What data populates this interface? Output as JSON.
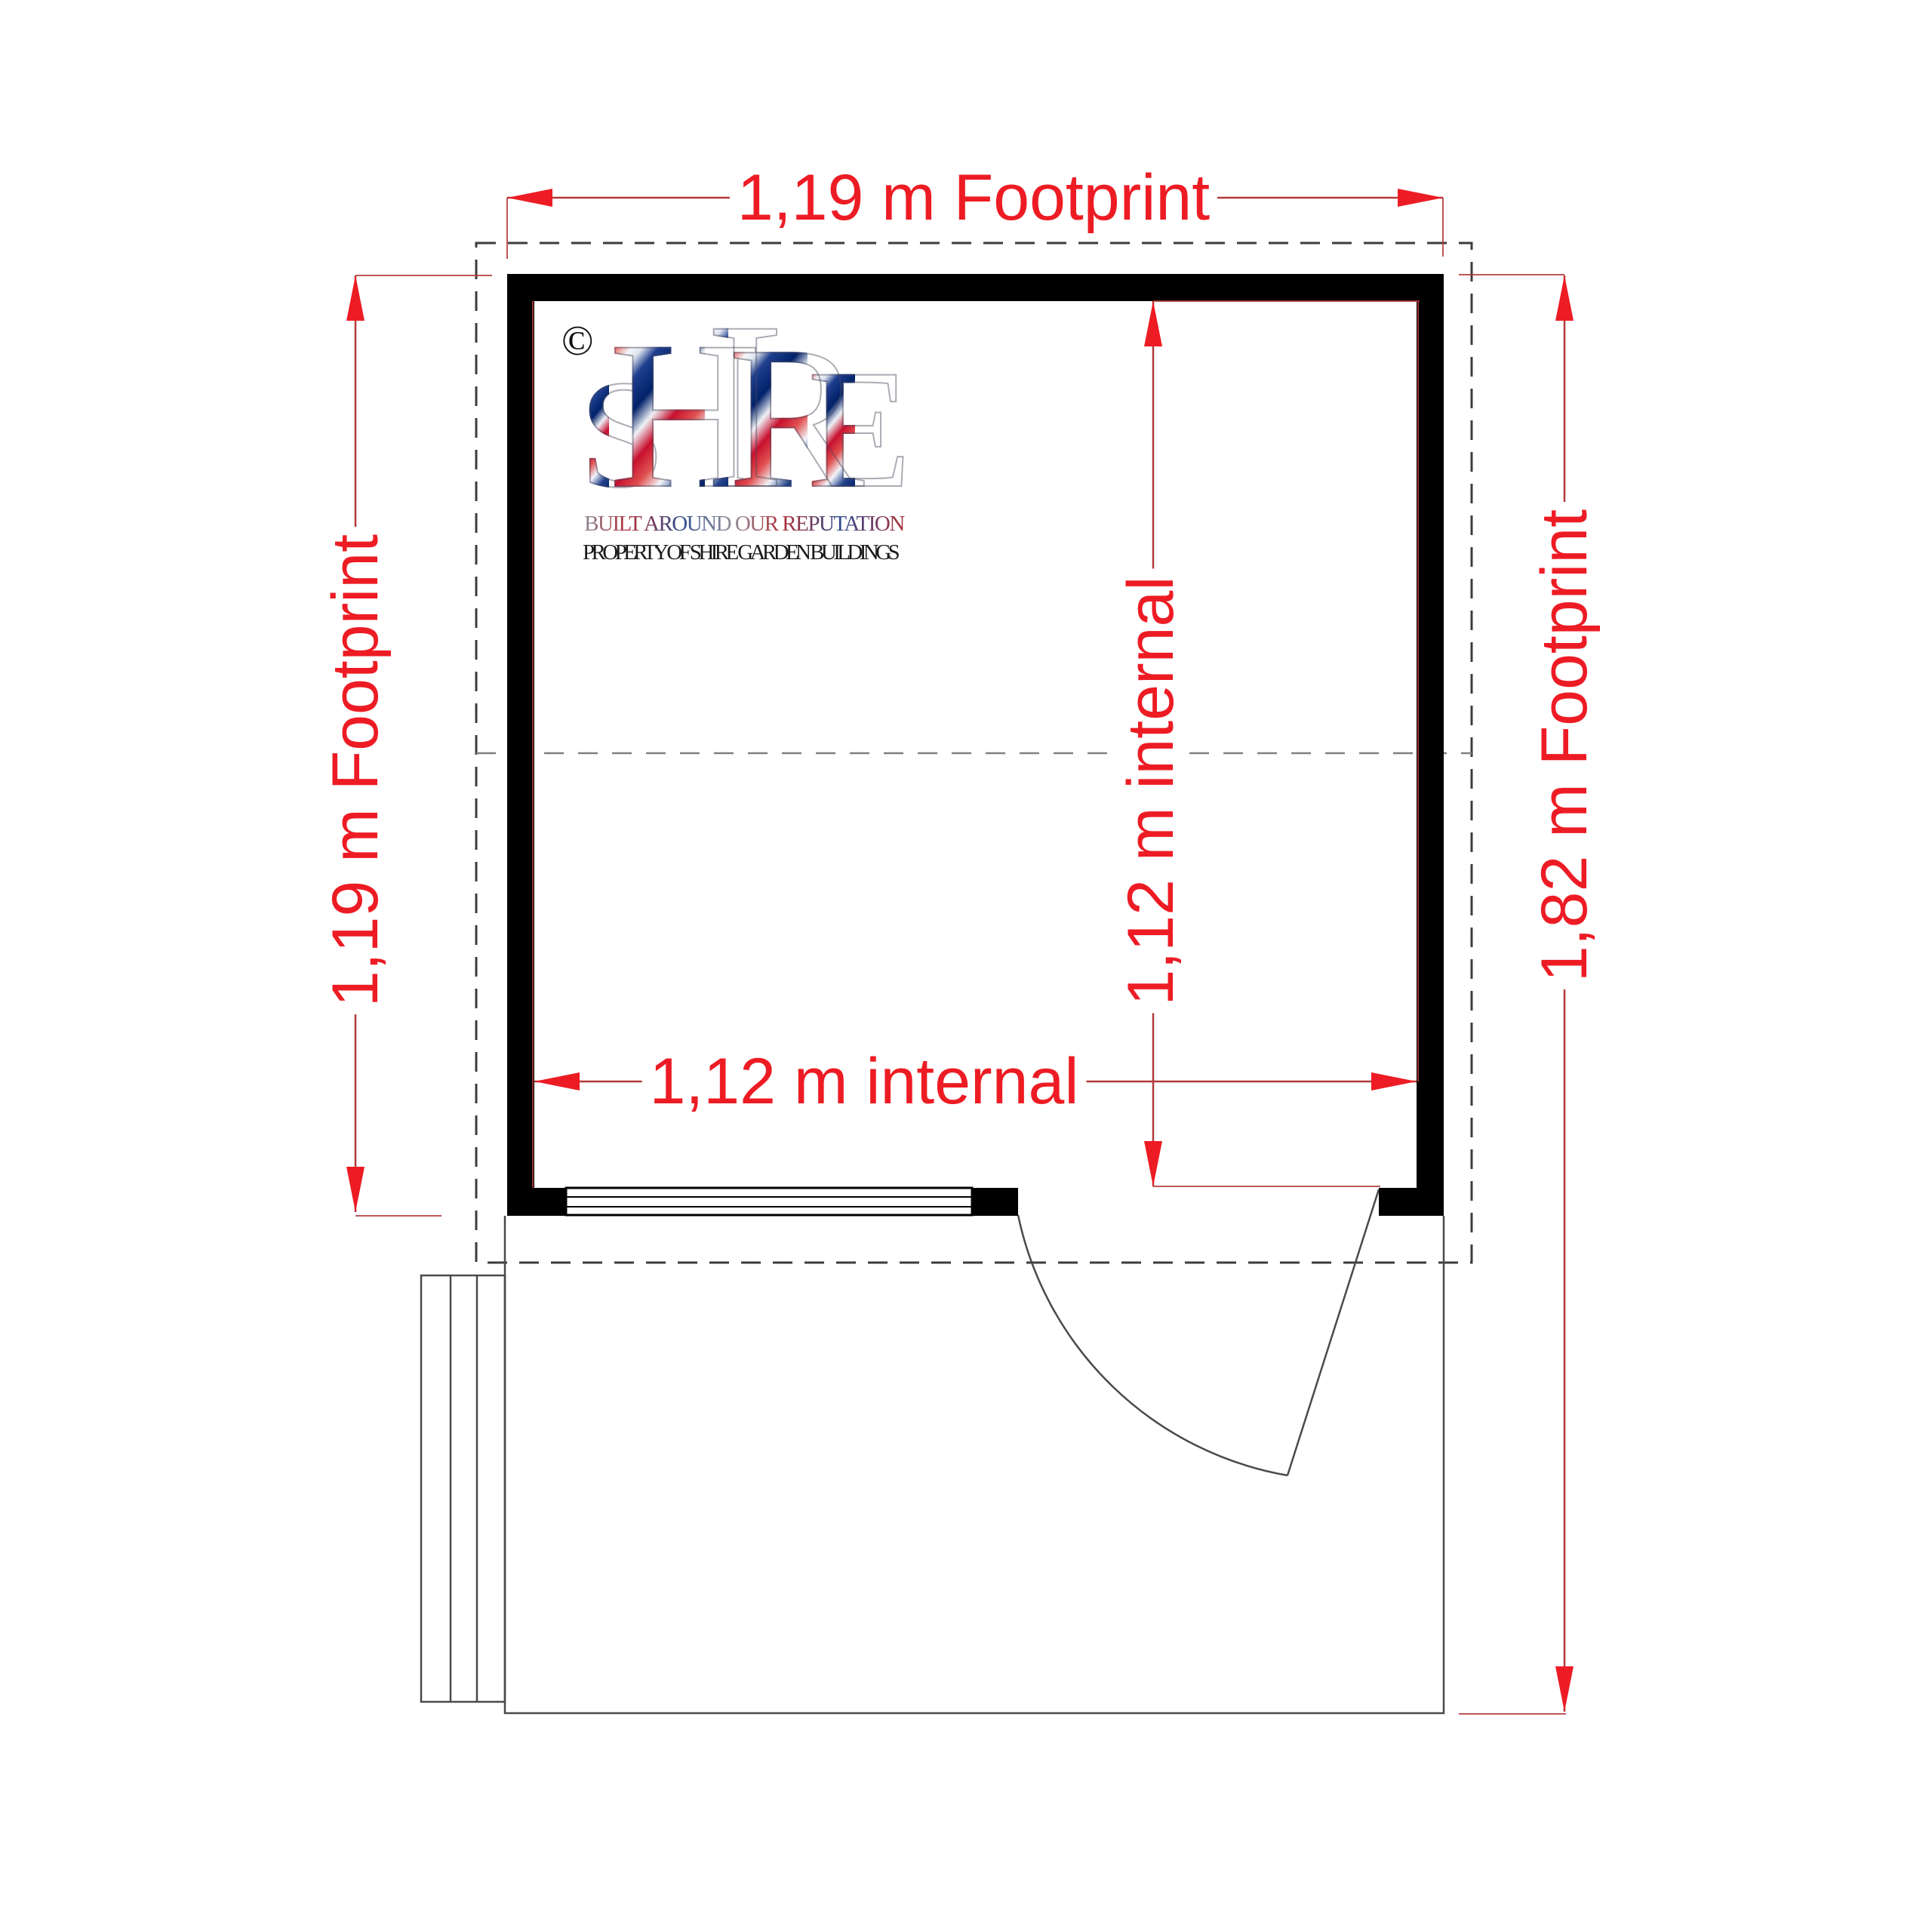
{
  "drawing": {
    "copyright": "©",
    "logo": {
      "letters": [
        "S",
        "H",
        "I",
        "R",
        "E"
      ],
      "tagline": "BUILT AROUND OUR REPUTATION",
      "property_line": "PROPERTY OF SHIRE GARDEN BUILDINGS"
    },
    "dimensions": {
      "footprint_width": "1,19 m Footprint",
      "footprint_depth": "1,19 m Footprint",
      "footprint_total_depth": "1,82 m Footprint",
      "internal_width": "1,12 m internal",
      "internal_depth": "1,12 m internal"
    },
    "colors": {
      "dimension_red": "#ed1c24",
      "dimension_line_red": "#b23a3a",
      "wall_black": "#000000",
      "dash_dark": "#3c3c3c",
      "dash_mid": "#808080",
      "outline_gray": "#4a4a4a"
    }
  }
}
